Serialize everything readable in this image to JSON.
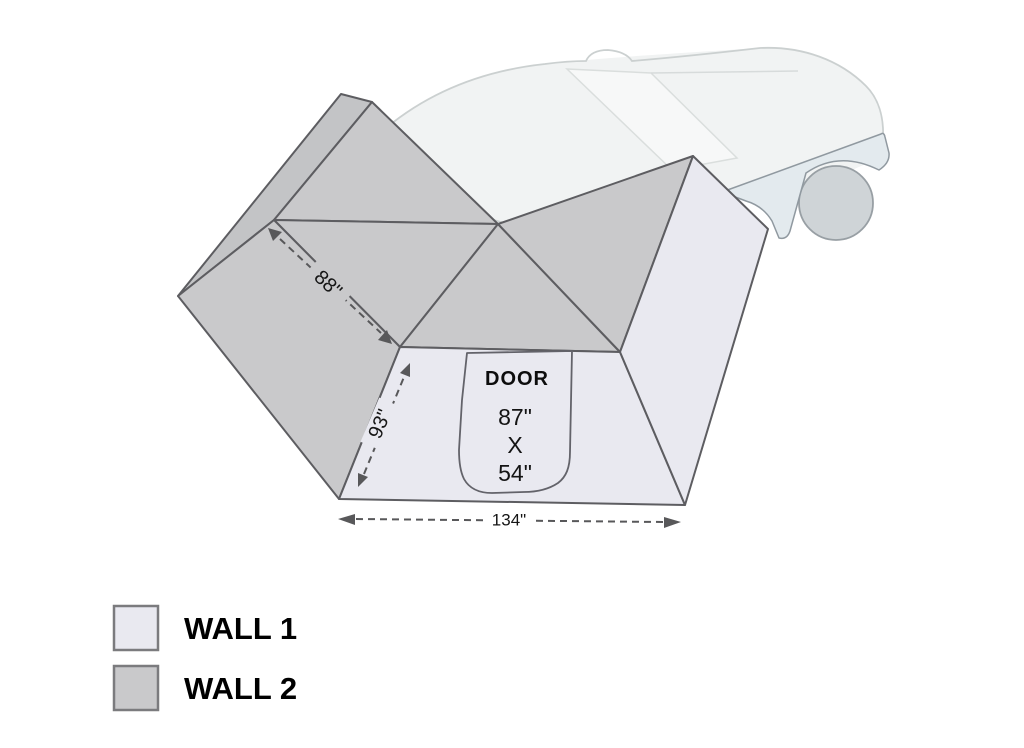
{
  "diagram": {
    "door": {
      "label": "DOOR",
      "dim_height": "87\"",
      "dim_separator": "X",
      "dim_width": "54\""
    },
    "dimensions": {
      "awning_edge": "88\"",
      "wall_height": "93\"",
      "base_width": "134\""
    },
    "legend": {
      "items": [
        {
          "label": "WALL 1",
          "color": "#e9e9f0"
        },
        {
          "label": "WALL 2",
          "color": "#c9c9cb"
        }
      ]
    },
    "colors": {
      "wall1": "#e9e9f0",
      "wall2": "#c9c9cb",
      "tent_outline": "#5d5d61",
      "dimension": "#58585a",
      "car_body": "#f1f3f3",
      "car_outline": "#cbd0d0",
      "car_rocker": "#e3eaee",
      "wheel": "#cfd4d7"
    }
  }
}
